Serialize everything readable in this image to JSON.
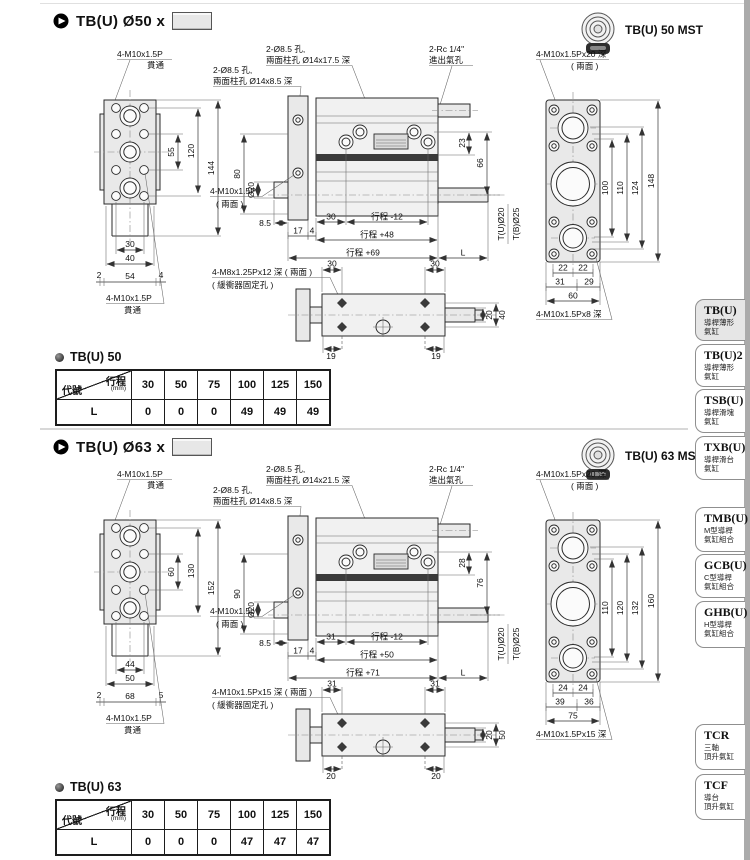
{
  "colors": {
    "line": "#2b2b2b",
    "panel_fill": "#e9e9e9",
    "tab_active_bg": "#e6e6e6",
    "rail": "#ababab"
  },
  "sections": [
    {
      "header_title": "TB(U) Ø50 x",
      "mst_label": "TB(U) 50 MST",
      "front": {
        "top1": "4-M10x1.5P",
        "top2": "貫通",
        "bot1": "4-M10x1.5P",
        "bot2": "貫通",
        "d_inner": "55",
        "d_mid": "120",
        "d_outer": "144",
        "b1": "30",
        "b2": "40",
        "c1": "2",
        "c2": "54",
        "c3": "4"
      },
      "side": {
        "holeM1": "2-Ø8.5 孔,",
        "holeM2": "兩面柱孔 Ø14x17.5 深",
        "port1": "2-Rc 1/4\"",
        "port2": "進出氣孔",
        "holeL1": "2-Ø8.5 孔,",
        "holeL2": "兩面柱孔 Ø14x8.5 深",
        "d15a": "15",
        "d15b": "15",
        "d_h": "80",
        "d_bore": "Ø20",
        "face1": "4-M10x1.5P",
        "face2": "( 兩面 )",
        "d85": "8.5",
        "d17": "17",
        "d4": "4",
        "d_pitch": "30",
        "s1": "行程 -12",
        "s2": "行程 +48",
        "s3": "行程 +69",
        "dL": "L",
        "r1": "23",
        "r2": "66",
        "rod1": "T(U)Ø20",
        "rod2": "T(B)Ø25"
      },
      "end": {
        "top1": "4-M10x1.5Px20 深",
        "top2": "( 兩面 )",
        "bot": "4-M10x1.5Px8 深",
        "d1": "100",
        "d2": "110",
        "d3": "124",
        "d4": "148",
        "b1a": "22",
        "b1b": "22",
        "b2a": "31",
        "b2b": "29",
        "b3": "60"
      },
      "bottom": {
        "l1": "4-M8x1.25Px12 深 ( 兩面 )",
        "l2": "( 緩衝器固定孔 )",
        "t1": "30",
        "t2": "30",
        "b1": "19",
        "b2": "19",
        "r1": "20",
        "r2": "40"
      },
      "table_title": "TB(U) 50",
      "table": {
        "corner_a": "行程",
        "corner_unit": "(mm)",
        "corner_b": "代號",
        "cols": [
          "30",
          "50",
          "75",
          "100",
          "125",
          "150"
        ],
        "row_label": "L",
        "values": [
          "0",
          "0",
          "0",
          "49",
          "49",
          "49"
        ]
      }
    },
    {
      "header_title": "TB(U) Ø63 x",
      "mst_label": "TB(U) 63 MST",
      "front": {
        "top1": "4-M10x1.5P",
        "top2": "貫通",
        "bot1": "4-M10x1.5P",
        "bot2": "貫通",
        "d_inner": "60",
        "d_mid": "130",
        "d_outer": "152",
        "b1": "44",
        "b2": "50",
        "c1": "2",
        "c2": "68",
        "c3": "5"
      },
      "side": {
        "holeM1": "2-Ø8.5 孔,",
        "holeM2": "兩面柱孔 Ø14x21.5 深",
        "port1": "2-Rc 1/4\"",
        "port2": "進出氣孔",
        "holeL1": "2-Ø8.5 孔,",
        "holeL2": "兩面柱孔 Ø14x8.5 深",
        "d15a": "15",
        "d15b": "15",
        "d_h": "90",
        "d_bore": "Ø20",
        "face1": "4-M10x1.5p",
        "face2": "( 兩面 )",
        "d85": "8.5",
        "d17": "17",
        "d4": "4",
        "d_pitch": "31",
        "s1": "行程 -12",
        "s2": "行程 +50",
        "s3": "行程 +71",
        "dL": "L",
        "r1": "28",
        "r2": "76",
        "rod1": "T(U)Ø20",
        "rod2": "T(B)Ø25"
      },
      "end": {
        "top1": "4-M10x1.5Px20 深",
        "top2": "( 兩面 )",
        "bot": "4-M10x1.5Px15 深",
        "d1": "110",
        "d2": "120",
        "d3": "132",
        "d4": "160",
        "b1a": "24",
        "b1b": "24",
        "b2a": "39",
        "b2b": "36",
        "b3": "75"
      },
      "bottom": {
        "l1": "4-M10x1.5Px15 深 ( 兩面 )",
        "l2": "( 緩衝器固定孔 )",
        "t1": "31",
        "t2": "31",
        "b1": "20",
        "b2": "20",
        "r1": "20",
        "r2": "50"
      },
      "table_title": "TB(U) 63",
      "table": {
        "corner_a": "行程",
        "corner_unit": "(mm)",
        "corner_b": "代號",
        "cols": [
          "30",
          "50",
          "75",
          "100",
          "125",
          "150"
        ],
        "row_label": "L",
        "values": [
          "0",
          "0",
          "0",
          "47",
          "47",
          "47"
        ]
      }
    }
  ],
  "sidebar": {
    "tabs": [
      {
        "name": "TB(U)",
        "d1": "導桿薄形",
        "d2": "氣缸"
      },
      {
        "name": "TB(U)2",
        "d1": "導桿薄形",
        "d2": "氣缸"
      },
      {
        "name": "TSB(U)",
        "d1": "導桿滑塊",
        "d2": "氣缸"
      },
      {
        "name": "TXB(U)",
        "d1": "導桿滑台",
        "d2": "氣缸"
      },
      {
        "name": "TMB(U)",
        "d1": "M型導桿",
        "d2": "氣缸組合"
      },
      {
        "name": "GCB(U)",
        "d1": "C型導桿",
        "d2": "氣缸組合"
      },
      {
        "name": "GHB(U)",
        "d1": "H型導桿",
        "d2": "氣缸組合"
      },
      {
        "name": "TCR",
        "d1": "三軸",
        "d2": "頂升氣缸"
      },
      {
        "name": "TCF",
        "d1": "導台",
        "d2": "頂升氣缸"
      }
    ]
  }
}
